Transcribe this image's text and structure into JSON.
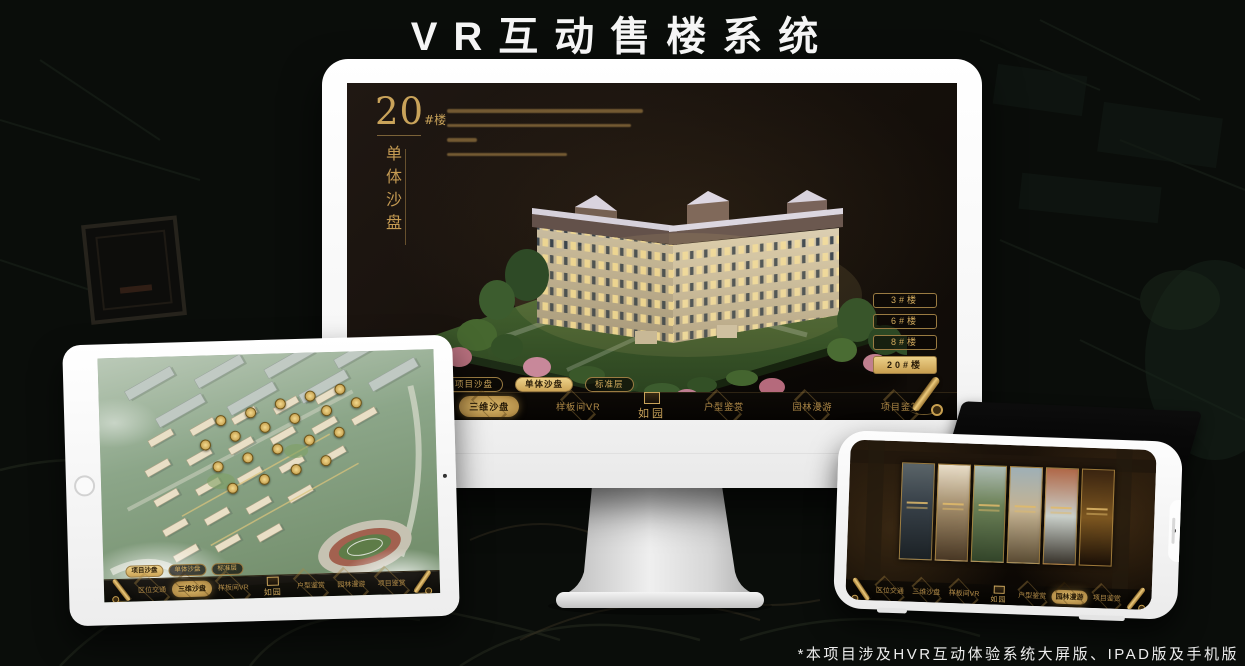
{
  "page": {
    "title": "VR互动售楼系统",
    "footnote": "*本项目涉及HVR互动体验系统大屏版、IPAD版及手机版"
  },
  "brand": {
    "logo_text": "如园"
  },
  "colors": {
    "gold": "#C9A050",
    "gold_bright": "#ECD088",
    "screen_bg": "#17110C",
    "active_text": "#2A1C08",
    "title_white": "#F5F5F5"
  },
  "monitor": {
    "headline_number": "20",
    "headline_suffix": "#楼",
    "headline_vertical": "单体沙盘",
    "intro_line_widths": [
      196,
      184,
      30,
      120
    ],
    "floor_buttons": [
      {
        "label": "3#楼",
        "active": false
      },
      {
        "label": "6#楼",
        "active": false
      },
      {
        "label": "8#楼",
        "active": false
      },
      {
        "label": "20#楼",
        "active": true
      }
    ],
    "view_tabs": [
      {
        "label": "项目沙盘",
        "active": false
      },
      {
        "label": "单体沙盘",
        "active": true
      },
      {
        "label": "标准层",
        "active": false
      }
    ],
    "nav_left": [
      {
        "label": "区位交通",
        "active": false
      },
      {
        "label": "三维沙盘",
        "active": true
      },
      {
        "label": "样板间VR",
        "active": false
      }
    ],
    "nav_right": [
      {
        "label": "户型鉴赏",
        "active": false
      },
      {
        "label": "园林漫游",
        "active": false
      },
      {
        "label": "项目鉴赏",
        "active": false
      }
    ]
  },
  "tablet": {
    "view_tabs": [
      {
        "label": "项目沙盘",
        "active": true
      },
      {
        "label": "单体沙盘",
        "active": false
      },
      {
        "label": "标准层",
        "active": false
      }
    ],
    "nav_left": [
      {
        "label": "区位交通",
        "active": false
      },
      {
        "label": "三维沙盘",
        "active": true
      },
      {
        "label": "样板间VR",
        "active": false
      }
    ],
    "nav_right": [
      {
        "label": "户型鉴赏",
        "active": false
      },
      {
        "label": "园林漫游",
        "active": false
      },
      {
        "label": "项目鉴赏",
        "active": false
      }
    ],
    "building_marker_count": 20
  },
  "phone": {
    "nav_left": [
      {
        "label": "区位交通",
        "active": false
      },
      {
        "label": "三维沙盘",
        "active": false
      },
      {
        "label": "样板间VR",
        "active": false
      }
    ],
    "nav_right": [
      {
        "label": "户型鉴赏",
        "active": false
      },
      {
        "label": "园林漫游",
        "active": true
      },
      {
        "label": "项目鉴赏",
        "active": false
      }
    ],
    "gallery_cards": [
      "courtyard-night",
      "bright-interior",
      "garden-gate",
      "residential-tower",
      "autumn-courtyard",
      "wine-cabinet"
    ]
  }
}
